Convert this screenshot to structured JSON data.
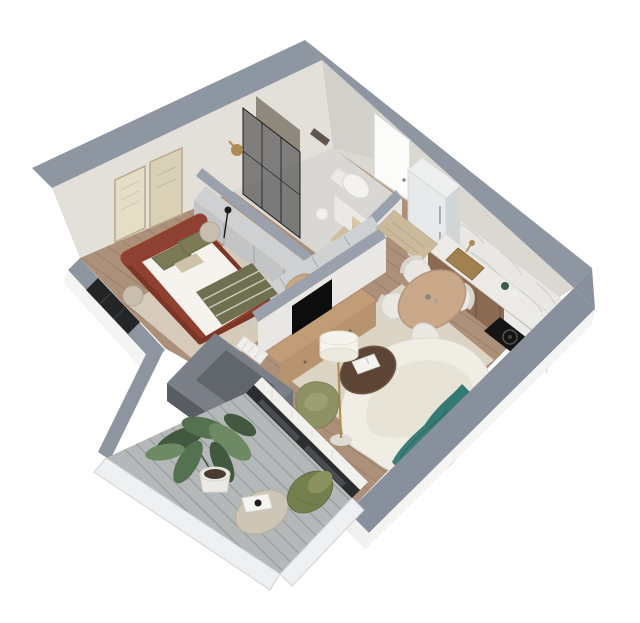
{
  "meta": {
    "title": "3D isometric cutaway floor plan render of a one-bedroom apartment",
    "view": "axonometric top-down cutaway",
    "background": "#ffffff"
  },
  "colors": {
    "wallTop": "#8e96a2",
    "frontWallTop": "#87909c",
    "balconyWallTop": "#8d95a0",
    "partitionTop": "#9aa1ac",
    "wallFaceNW": "#e3e0da",
    "wallFaceNE": "#dbd8d2",
    "partitionFace": "#e9e7e3",
    "exterior": "#f4f4f3",
    "woodFloor": "#ad907a",
    "bathFloor": "#d9d7d3",
    "deck": "#b5b8b9",
    "railing": "#eef0f1",
    "rugBedroom": "#d6cbbb",
    "rugLiving": "#dbd4c4",
    "bedFrame": "#8f4030",
    "duvet": "#f6f3ee",
    "blanket": "#6f7050",
    "pillowOlive": "#7b7a54",
    "pillowBeige": "#cfc2ab",
    "nightstand": "#c8bdae",
    "cabinetGray": "#ced0d2",
    "cabinetGrayDark": "#c2c4c6",
    "artFrame1": "#e5ddc6",
    "artFrame2": "#d9d0b6",
    "glassDark": "rgba(45,45,48,0.55)",
    "brass": "#ad8b52",
    "toiletWhite": "#f3f2f0",
    "doorWhite": "#fbfbfa",
    "doormat": "#cbb99c",
    "bathmat": "#cfbfa1",
    "towel": "#d8c8a6",
    "fridge": "#e7e9ea",
    "fridgeSide": "#d2d5d6",
    "counterWood": "#8a6b51",
    "marble": "#eceae6",
    "backsplash": "#e9e7e3",
    "cooktop": "#151515",
    "tableWood": "#c9a98a",
    "chairWhite": "#eae8e2",
    "sofa": "#f0ede4",
    "sofaSeat": "#e7e3d6",
    "throw": "#3c7e77",
    "walnut": "#5d4536",
    "lampShade": "#f5f3ec",
    "armchair": "#8e9164",
    "consoleWood": "#b7946f",
    "tv": "#0d0d0e",
    "shaftOuter": "#7a7f88",
    "shaftInner": "#61656c",
    "windowDark": "#232527",
    "doorFrameDark": "#2b2d2f",
    "curtain": "#f1f0ec",
    "plant": "#547250",
    "plantDark": "#42593f",
    "plantLight": "#6d8a64",
    "pot": "#ebeae6",
    "stoneTable": "#cdc5b6",
    "pouf": "#747f4e",
    "poufPillow": "#8b9260",
    "radiator": "#efeeea"
  },
  "rooms": {
    "bedroom": {
      "name": "bedroom",
      "furniture": [
        "double-bed",
        "headboard",
        "olive-throw-blanket",
        "pillows",
        "nightstand-left",
        "nightstand-right",
        "wall-art-frames",
        "wardrobe",
        "dresser",
        "bench-stool",
        "rug",
        "radiator",
        "window"
      ]
    },
    "bathroom": {
      "name": "bathroom",
      "furniture": [
        "glass-shower",
        "brass-shower-head",
        "wall-hung-toilet",
        "half-wall",
        "towel",
        "waste-bin",
        "bath-mat"
      ]
    },
    "hallway": {
      "name": "entrance hall",
      "furniture": [
        "entry-door",
        "doormat",
        "fridge"
      ]
    },
    "kitchen": {
      "name": "kitchen",
      "furniture": [
        "wood-base-cabinets",
        "marble-countertop",
        "marble-backsplash",
        "sink",
        "brass-faucet",
        "induction-cooktop",
        "round-dining-table",
        "dining-chairs"
      ]
    },
    "living_room": {
      "name": "living room",
      "furniture": [
        "tv-partition-wall",
        "tv",
        "media-console",
        "curved-boucle-sofa",
        "teal-throw",
        "round-coffee-table",
        "book",
        "floor-lamp",
        "olive-armchair",
        "rug",
        "sliding-glass-door",
        "sheer-curtain"
      ]
    },
    "balcony": {
      "name": "balcony",
      "furniture": [
        "gray-plank-deck",
        "glass-railing",
        "potted-plant",
        "stone-side-table",
        "serving-tray",
        "olive-pouf",
        "pouf-pillow"
      ]
    },
    "technical": {
      "name": "service shaft",
      "furniture": [
        "concrete-shaft"
      ]
    }
  }
}
